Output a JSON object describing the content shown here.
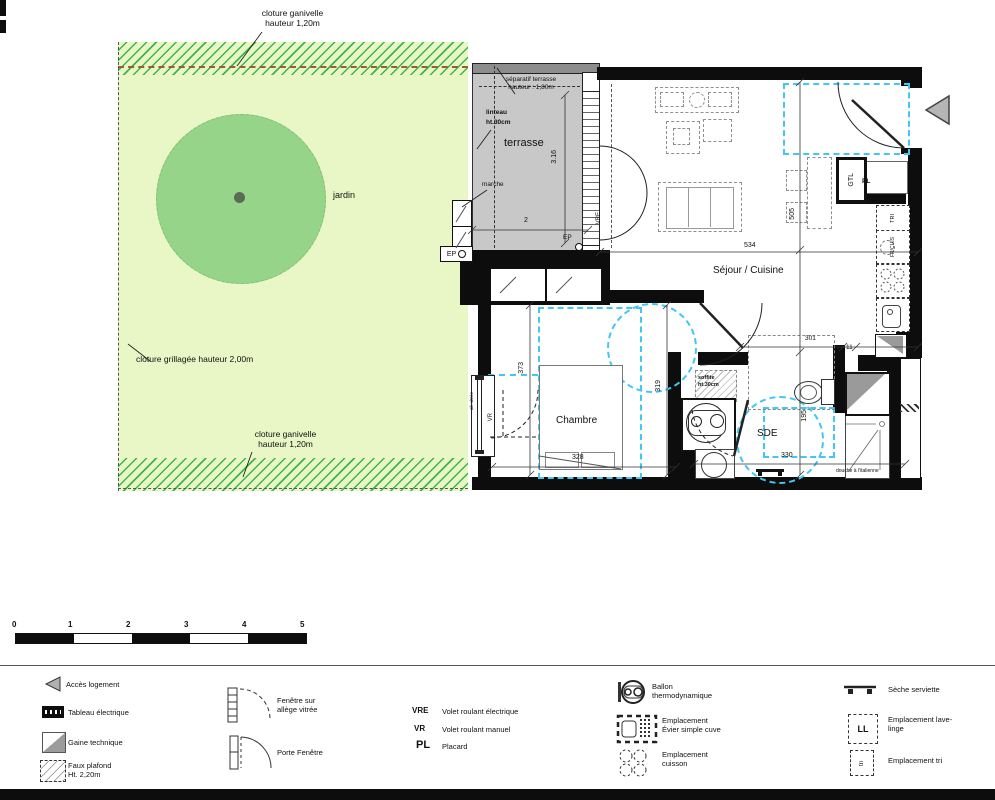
{
  "plan": {
    "garden": {
      "jardin": "jardin",
      "fence_top": "cloture ganivelle\nhauteur 1,20m",
      "fence_left": "cloture grillagée hauteur 2,00m",
      "fence_bottom": "cloture ganivelle\nhauteur 1,20m"
    },
    "terrace": {
      "name": "terrasse",
      "separatif": "séparatif terrasse\nhauteur : 1,80m",
      "linteau": "linteau",
      "linteau_ht": "ht.30cm",
      "marche": "marche",
      "ep": "EP"
    },
    "rooms": {
      "sejour": "Séjour / Cuisine",
      "chambre": "Chambre",
      "sde": "SDE"
    },
    "tags": {
      "vre": "VRE",
      "vr": "VR",
      "gtl": "GTL",
      "pl": "PL",
      "tri": "TRI",
      "fr_cuis": "FR/CUIS",
      "all_vitree": "all. vitrée",
      "soffite": "soffite\nht.30cm",
      "douche": "douche à l'italienne"
    },
    "dims": {
      "terrasse_l": "3.16",
      "terrasse_w": "2",
      "sejour_w": "534",
      "sejour_l": "505",
      "entree": "301",
      "cloison": "11",
      "chambre_l": "373",
      "chambre_d": "319",
      "chambre_w": "328",
      "sde_l": "195",
      "sde_w": "330"
    }
  },
  "scalebar": {
    "ticks": [
      "0",
      "1",
      "2",
      "3",
      "4",
      "5"
    ]
  },
  "legend": {
    "acces": "Accès logement",
    "tableau": "Tableau électrique",
    "gaine": "Gaine technique",
    "faux_plafond": "Faux plafond\nHt. 2,20m",
    "fenetre": "Fenêtre sur\nallège vitrée",
    "porte": "Porte Fenêtre",
    "vre_abbr": "VRE",
    "vre_desc": "Volet roulant électrique",
    "vr_abbr": "VR",
    "vr_desc": "Volet roulant manuel",
    "pl_abbr": "PL",
    "pl_desc": "Placard",
    "ballon": "Ballon\nthermodynamique",
    "evier": "Emplacement\nÉvier simple cuve",
    "cuisson": "Emplacement\ncuisson",
    "seche": "Sèche serviette",
    "ll_abbr": "LL",
    "lave_linge": "Emplacement lave-\nlinge",
    "tri_abbr": "tri",
    "tri_desc": "Emplacement tri"
  }
}
